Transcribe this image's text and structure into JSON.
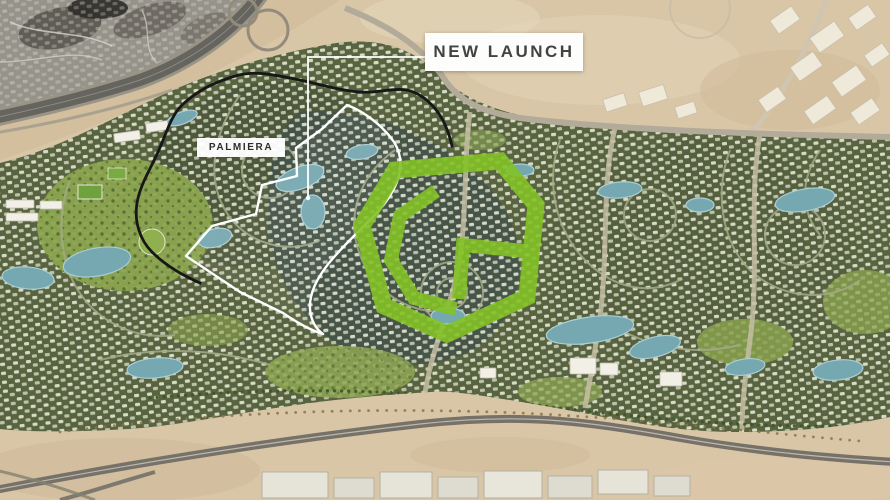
{
  "labels": {
    "new_launch": "NEW LAUNCH",
    "palmiera": "PALMIERA"
  },
  "colors": {
    "highlight_green": "#83c226",
    "boundary_black": "#171717",
    "boundary_white": "#ffffff",
    "label_text": "#434343",
    "desert": "#d9c6a7",
    "development_olive": "#58633f",
    "water_blue": "#76a8b2",
    "park_green": "#8ca450"
  }
}
